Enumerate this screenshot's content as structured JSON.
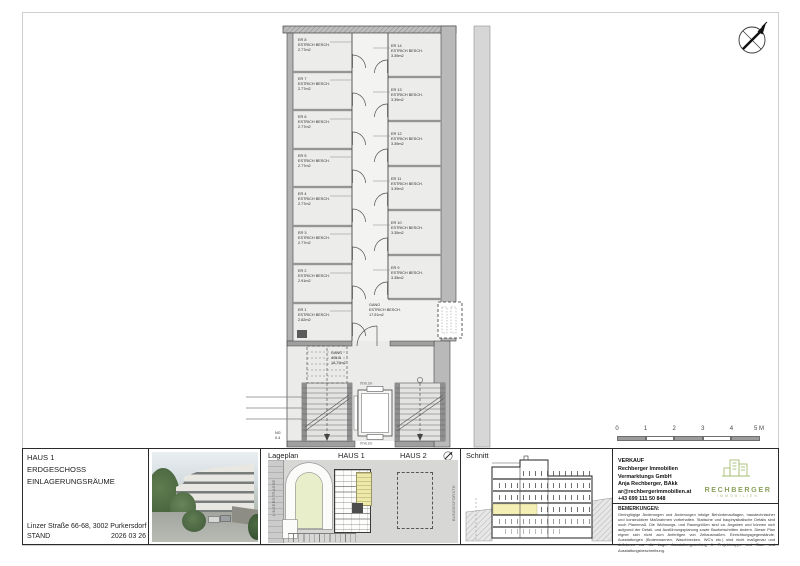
{
  "sheet": {
    "project": {
      "line1": "HAUS 1",
      "line2": "ERDGESCHOSS",
      "line3": "EINLAGERUNGSRÄUME"
    },
    "address": "Linzer Straße 66-68, 3002 Purkersdorf",
    "stand_label": "STAND",
    "stand_date": "2026 03 26"
  },
  "plan": {
    "left_rooms": [
      {
        "id": "ER 8",
        "desc": "ESTRICH BESCH.",
        "area": "2.77m2"
      },
      {
        "id": "ER 7",
        "desc": "ESTRICH BESCH.",
        "area": "2.77m2"
      },
      {
        "id": "ER 6",
        "desc": "ESTRICH BESCH.",
        "area": "2.77m2"
      },
      {
        "id": "ER 5",
        "desc": "ESTRICH BESCH.",
        "area": "2.77m2"
      },
      {
        "id": "ER 4",
        "desc": "ESTRICH BESCH.",
        "area": "2.77m2"
      },
      {
        "id": "ER 3",
        "desc": "ESTRICH BESCH.",
        "area": "2.77m2"
      },
      {
        "id": "ER 2",
        "desc": "ESTRICH BESCH.",
        "area": "2.91m2"
      },
      {
        "id": "ER 1",
        "desc": "ESTRICH BESCH.",
        "area": "2.82m2"
      }
    ],
    "right_rooms": [
      {
        "id": "ER 14",
        "desc": "ESTRICH BESCH.",
        "area": "3.39m2"
      },
      {
        "id": "ER 13",
        "desc": "ESTRICH BESCH.",
        "area": "3.39m2"
      },
      {
        "id": "ER 12",
        "desc": "ESTRICH BESCH.",
        "area": "3.39m2"
      },
      {
        "id": "ER 11",
        "desc": "ESTRICH BESCH.",
        "area": "3.39m2"
      },
      {
        "id": "ER 10",
        "desc": "ESTRICH BESCH.",
        "area": "3.35m2"
      },
      {
        "id": "ER 9",
        "desc": "ESTRICH BESCH.",
        "area": "3.35m2"
      }
    ],
    "gang_room": {
      "id": "GANG",
      "desc": "ESTRICH BESCH.",
      "area": "17.51m2"
    },
    "stair_hall": {
      "name": "GANG",
      "number": "405.B",
      "area": "18.79m2"
    },
    "elevator_dim_top": "97x6.2m",
    "elevator_dim_bottom": "97x6.2m",
    "edge_label_1": "NG",
    "edge_label_2": "0.4"
  },
  "scale_bar": {
    "labels": [
      "0",
      "1",
      "2",
      "3",
      "4"
    ],
    "end_label": "5 M"
  },
  "lageplan": {
    "label": "Lageplan",
    "haus1_label": "HAUS 1",
    "haus2_label": "HAUS 2",
    "street_label": "LINZERSTRASSE",
    "forest_label": "BUNDESFORSTE"
  },
  "schnitt": {
    "label": "Schnitt"
  },
  "verkauf": {
    "heading": "VERKAUF",
    "company1": "Rechberger Immobilien",
    "company2": "Vermarktungs GmbH",
    "contact": "Anja Rechberger, BAkk",
    "email": "ar@rechbergerimmobilien.at",
    "phone": "+43 699 111 50 848"
  },
  "logo": {
    "name": "RECHBERGER",
    "sub": "IMMOBILIEN"
  },
  "bemerkungen": {
    "heading": "BEMERKUNGEN:",
    "text": "Geringfügige Änderungen und Änderungen infolge Behördenauflagen, haustechnischer und konstruktiver Maßnahmen vorbehalten. Statische und bauphysikalische Details sind noch Plannmaß. Die Wohnungs- und Raumgrößen sind ca. Angaben und können sich aufgrund der Detail- und Ausführungsplanung sowie Baufortschritten ändern. Dieser Plan eignet sich nicht zum Anfertigen von Zeitausmaßen. Einrichtungsgegenstände, Ausstattungen (Bodenwannen, Waschbecken, WC's etc.) sind nicht maßgenau und definieren nur die Lage. Ausstattungsumfang lt. Projektmappe und Bau- und Ausstattungsbeschreibung."
  }
}
